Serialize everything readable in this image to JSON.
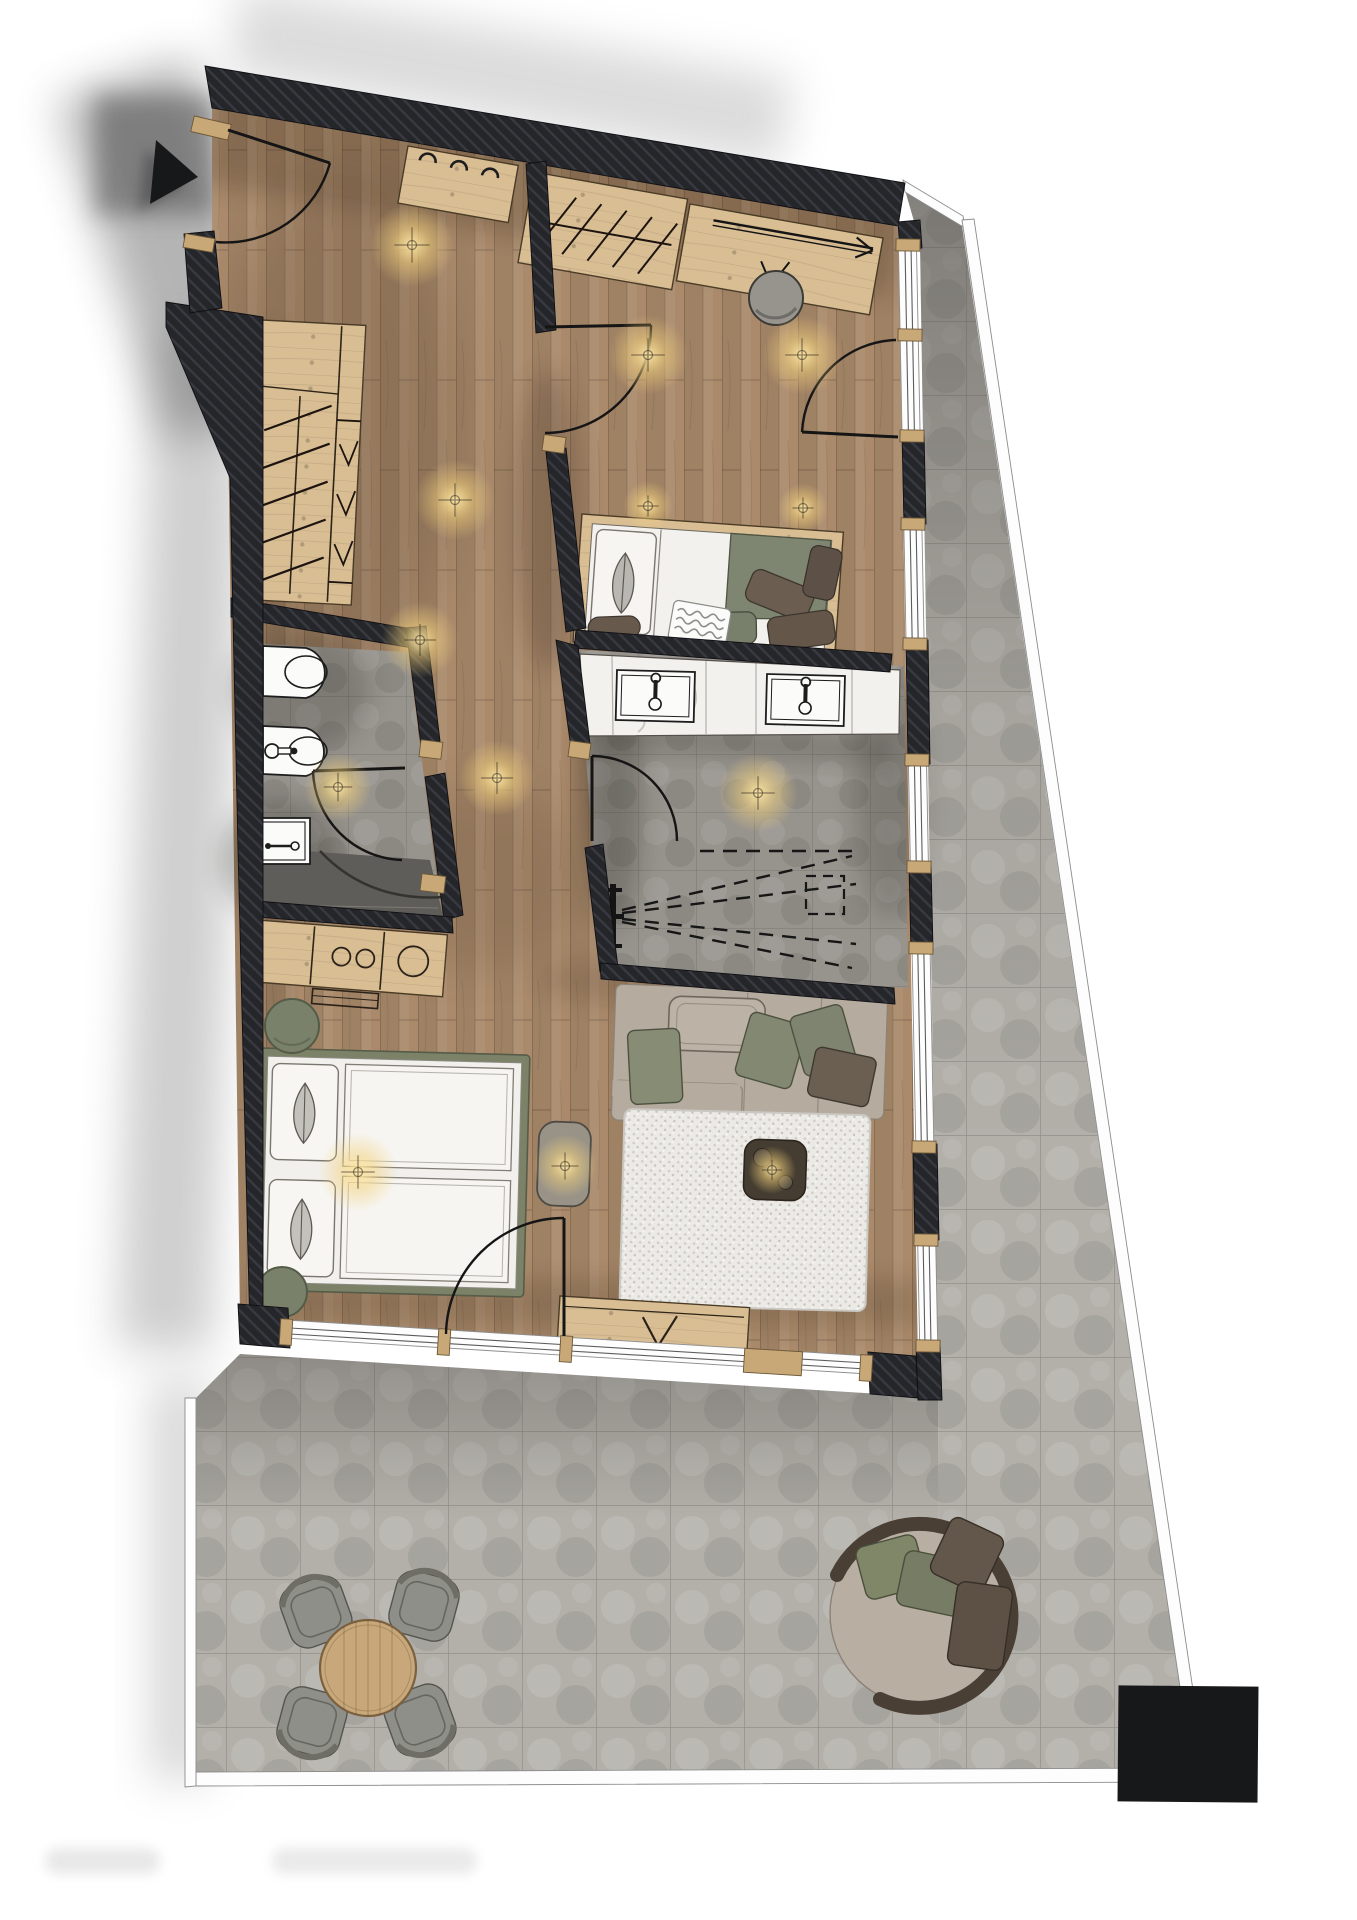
{
  "palette": {
    "wall": "#25262a",
    "hatchline": "#383941",
    "wood": "#aa8a6b",
    "fwood": "#d9be94",
    "sill": "#c9a877",
    "ttile": "#b3b0aa",
    "btile": "#97938d",
    "tiledark": "#5f5d59",
    "whitesoft": "#f2f1ed",
    "olive": "#7e8570",
    "framegreen": "#7b8268",
    "sofa": "#b5ab9e",
    "brown": "#6b5e51",
    "graychair": "#8f8f89",
    "daybed": "#b9aea2",
    "tablewood": "#c8a87a",
    "rugbase": "#eceae6",
    "black": "#17181a",
    "glow": "#ffe9a8"
  },
  "lights": [
    {
      "x": 412,
      "y": 245,
      "r": 42
    },
    {
      "x": 648,
      "y": 355,
      "r": 40
    },
    {
      "x": 802,
      "y": 355,
      "r": 40
    },
    {
      "x": 648,
      "y": 506,
      "r": 25
    },
    {
      "x": 803,
      "y": 508,
      "r": 25
    },
    {
      "x": 455,
      "y": 500,
      "r": 40
    },
    {
      "x": 420,
      "y": 640,
      "r": 38
    },
    {
      "x": 497,
      "y": 778,
      "r": 38
    },
    {
      "x": 758,
      "y": 793,
      "r": 40
    },
    {
      "x": 338,
      "y": 787,
      "r": 34
    },
    {
      "x": 358,
      "y": 1172,
      "r": 40
    },
    {
      "x": 565,
      "y": 1166,
      "r": 32
    },
    {
      "x": 772,
      "y": 1170,
      "r": 24
    }
  ]
}
